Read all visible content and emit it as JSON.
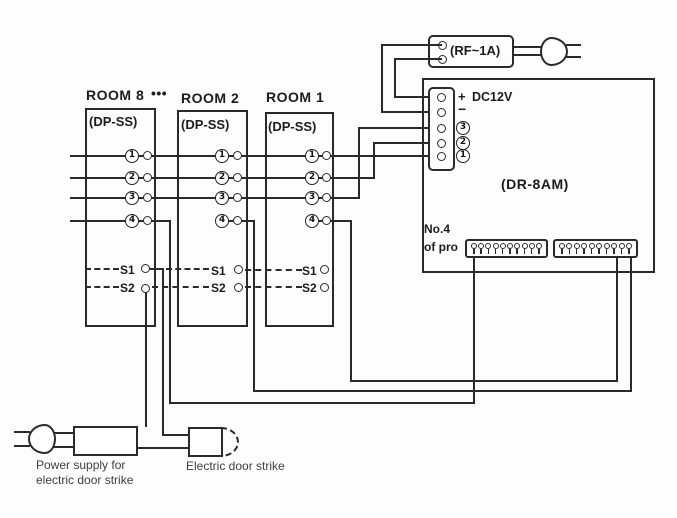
{
  "rooms": [
    {
      "title": "ROOM 8",
      "subtitle": "(DP-SS)",
      "terminals": [
        "1",
        "2",
        "3",
        "4"
      ],
      "s1": "S1",
      "s2": "S2"
    },
    {
      "title": "ROOM 2",
      "subtitle": "(DP-SS)",
      "terminals": [
        "1",
        "2",
        "3",
        "4"
      ],
      "s1": "S1",
      "s2": "S2"
    },
    {
      "title": "ROOM 1",
      "subtitle": "(DP-SS)",
      "terminals": [
        "1",
        "2",
        "3",
        "4"
      ],
      "s1": "S1",
      "s2": "S2"
    }
  ],
  "room_ellipsis": "•••",
  "rf_unit": {
    "label": "(RF~1A)"
  },
  "dr_unit": {
    "label": "(DR-8AM)",
    "plus": "+",
    "dc_label": "DC12V",
    "minus": "−",
    "circled_terminals": [
      "3",
      "2",
      "1"
    ],
    "note_line1": "No.4",
    "note_line2": "of pro",
    "connector_pin_count": 10
  },
  "bottom": {
    "power_supply_label_line1": "Power supply for",
    "power_supply_label_line2": "electric door strike",
    "door_strike_label": "Electric door strike"
  },
  "line_color": "#2a2a2a"
}
